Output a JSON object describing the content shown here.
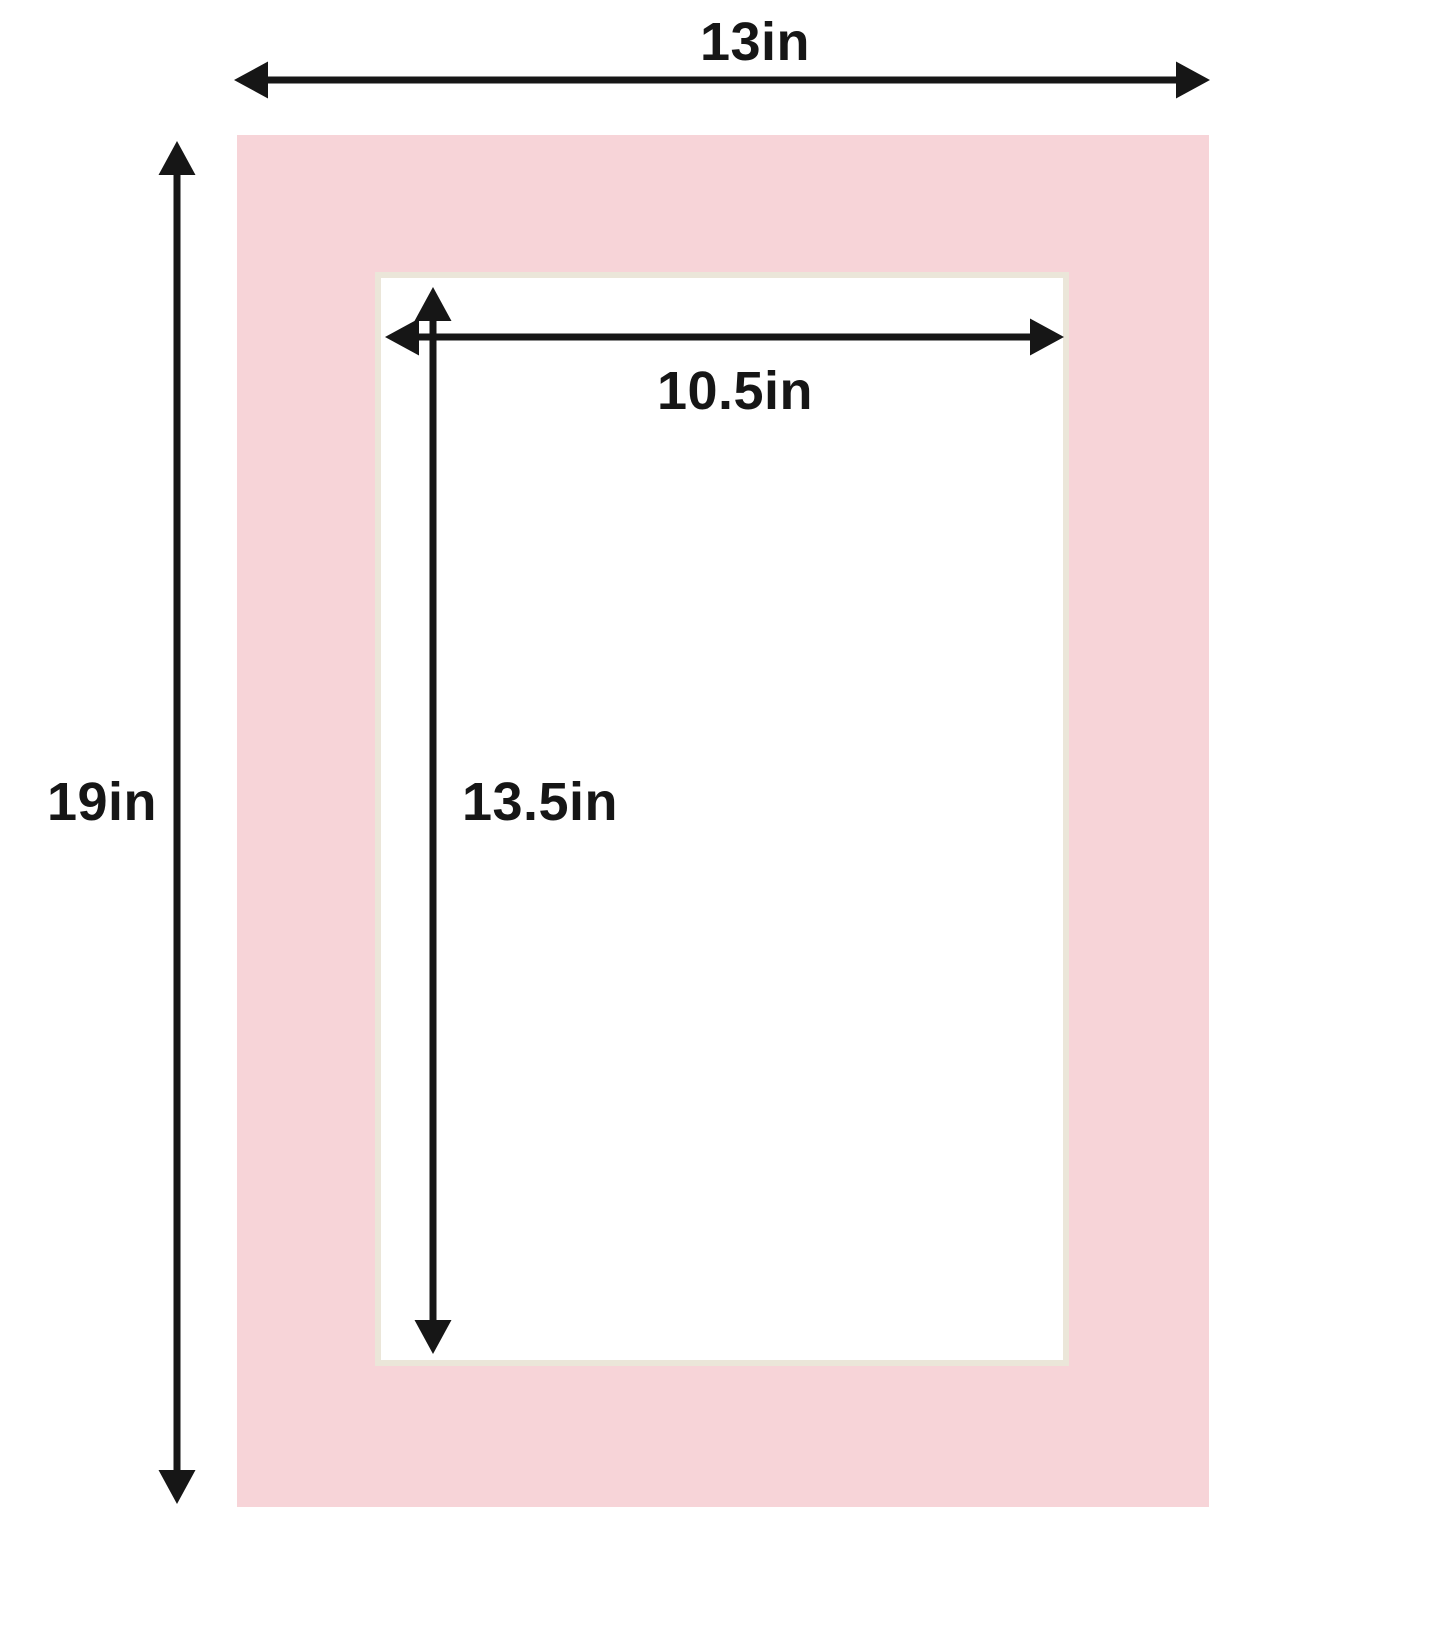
{
  "labels": {
    "outer_width": "13in",
    "outer_height": "19in",
    "opening_width": "10.5in",
    "opening_height": "13.5in"
  },
  "colors": {
    "mat": "#f7d4d8",
    "bevel": "#ebe6d9",
    "arrow": "#161616",
    "background": "#ffffff"
  },
  "icons": {
    "outer_width_arrow": "horizontal-double-headed-arrow",
    "outer_height_arrow": "vertical-double-headed-arrow",
    "opening_width_arrow": "horizontal-double-headed-arrow",
    "opening_height_arrow": "vertical-double-headed-arrow"
  }
}
